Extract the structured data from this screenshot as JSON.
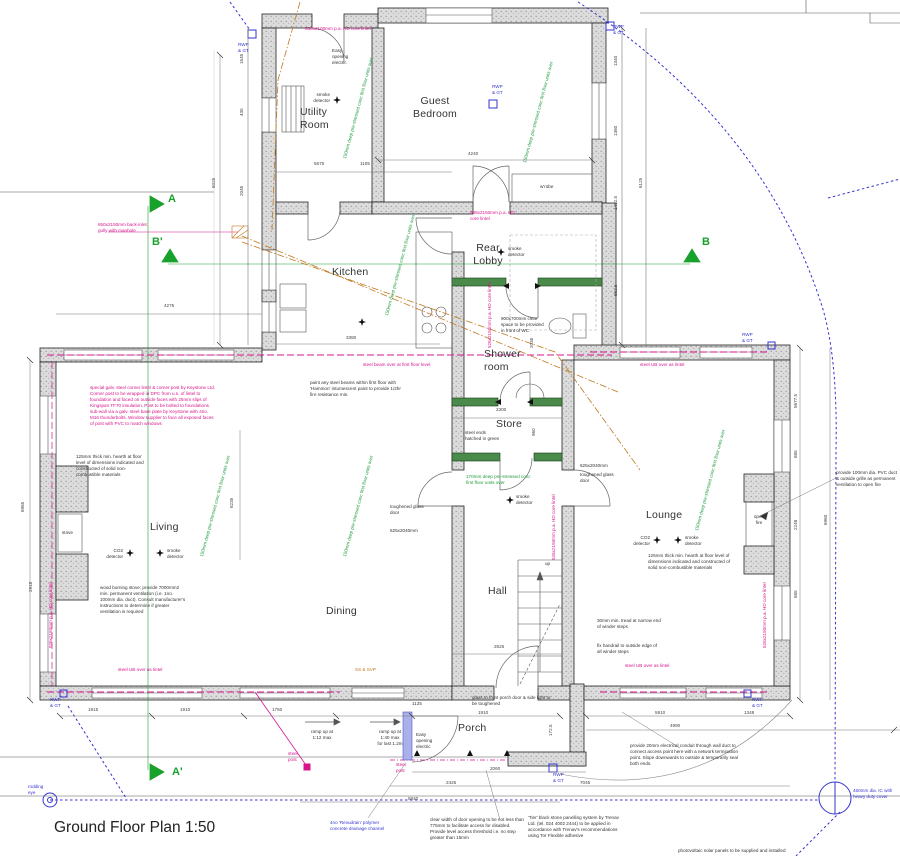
{
  "title": "Ground Floor Plan 1:50",
  "rooms": {
    "utility": "Utility\nRoom",
    "guest": "Guest\nBedroom",
    "kitchen": "Kitchen",
    "rear_lobby": "Rear\nLobby",
    "shower": "Shower\nroom",
    "store": "Store",
    "living": "Living",
    "dining": "Dining",
    "hall": "Hall",
    "lounge": "Lounge",
    "porch": "Porch",
    "up": "up",
    "stove": "stove",
    "open_fire": "open\nfire",
    "wardrobe": "w'robe"
  },
  "sections": {
    "a": "A",
    "a2": "A'",
    "b": "B",
    "b2": "B'"
  },
  "notes": {
    "corner_post": "special galv. steel corner lintel & corner post by Keystone Ltd. Corner post to be wrapped in DPC from u.s. of lintel to foundation and faced on outside faces with 25mm slips of Kingspan TF70 insulation. Post to be bolted to foundations sub-wall via a galv. steel base plate by Keystone with 4no. M16 thunderbolts. Window supplier to face all exposed faces of post with PVC to match windows",
    "steel_beam": "steel beam over at first floor level",
    "steel_ub": "steel UB over as lintel",
    "gully": "650x2150mm back-inlet gully with manhole",
    "lintel_top": "650x2100mm p.a. HD core lintel",
    "lintel_guest": "938x2150mm p.a. HD core lintel",
    "lintel_v": "526x2150mm p.a. HD core lintel",
    "steel_post": "steel\npost",
    "ss_svp": "SS & SVP",
    "floor_units": "150mm deep pre-stressed conc first floor units over",
    "floor_units2": "170mm deep pre-stressed conc\nfirst floor units over",
    "steel_ends": "steel ends\nhatched in green",
    "rwp": "RWP\n& GT",
    "ic": "450mm dia. IC with\nheavy duty cover",
    "rodding": "rodding\neye",
    "channel": "4no 'Revudrain' polymer\nconcrete drainage channel",
    "paint_steel": "paint any steel beams within first floor with 'Hammon' intumescent paint to provide 1/2hr fire resistance min.",
    "hearth": "125mm thick min. hearth at floor level of dimensions indicated and constructed of solid non-combustible materials",
    "stove_vent": "wood burning stove; provide 7000mm2 min. permanent ventilation (i.e. 1no. 100mm dia. duct). Consult manufacturer's instructions to determine if greater ventilation is required",
    "wc_space": "900x700mm clear space to be provided in front of WC",
    "winder1": "30mm min. tread at narrow end of winder steps",
    "winder2": "fix handrail to outside edge of all winder steps",
    "porch_glass": "glass to front porch door & side light to be toughened",
    "door_width": "clear width of door opening to be not less than 775mm to facilitate access for disabled. Provide level access threshold i.e. no step greater than 15mm",
    "tier": "'Tier' black stone panelling system by Trenav Ltd. (tel. 024 4002 2444) to be applied in accordance with Trenav's recommendations using Tor Flexible adhesive",
    "conduit": "provide 20mm electrical conduit through wall duct to connect access point here with a network termination point. Slope downwards to outside & temporarily seal both ends.",
    "pv": "photovoltaic solar panels to be supplied and installed",
    "ramp1": "ramp up at\n1:12 max",
    "ramp2": "ramp up at\n1:40 max\nfor last 1.2m",
    "easy": "Easy\nopening\nelectric",
    "smoke": "smoke\ndetector",
    "co2": "CO2\ndetector",
    "tough": "toughened glass\ndoor",
    "d625": "625x2040mm",
    "vent_fire": "provide 100mm dia. PVC duct & outside grille as permanent ventilation to open fire"
  },
  "dims": [
    "1915",
    "1910",
    "1750",
    "1135",
    "1910",
    "172.5",
    "2060",
    "2425",
    "7045",
    "5840",
    "5910",
    "1348",
    "4990",
    "6965",
    "2918",
    "5677.5",
    "685",
    "2248",
    "685",
    "6960",
    "1340",
    "1360",
    "1402.5",
    "552.5",
    "6125",
    "6025",
    "1545",
    "435",
    "2045",
    "4240",
    "5675",
    "1105",
    "3380",
    "2300",
    "2625",
    "6235",
    "4275",
    "2035",
    "960"
  ],
  "colors": {
    "magenta": "#d6158c",
    "green": "#1f9d3f",
    "blue": "#3434cf",
    "orange": "#c07820",
    "wall": "#dcdcdc",
    "steel_green": "#4a8a4a"
  }
}
